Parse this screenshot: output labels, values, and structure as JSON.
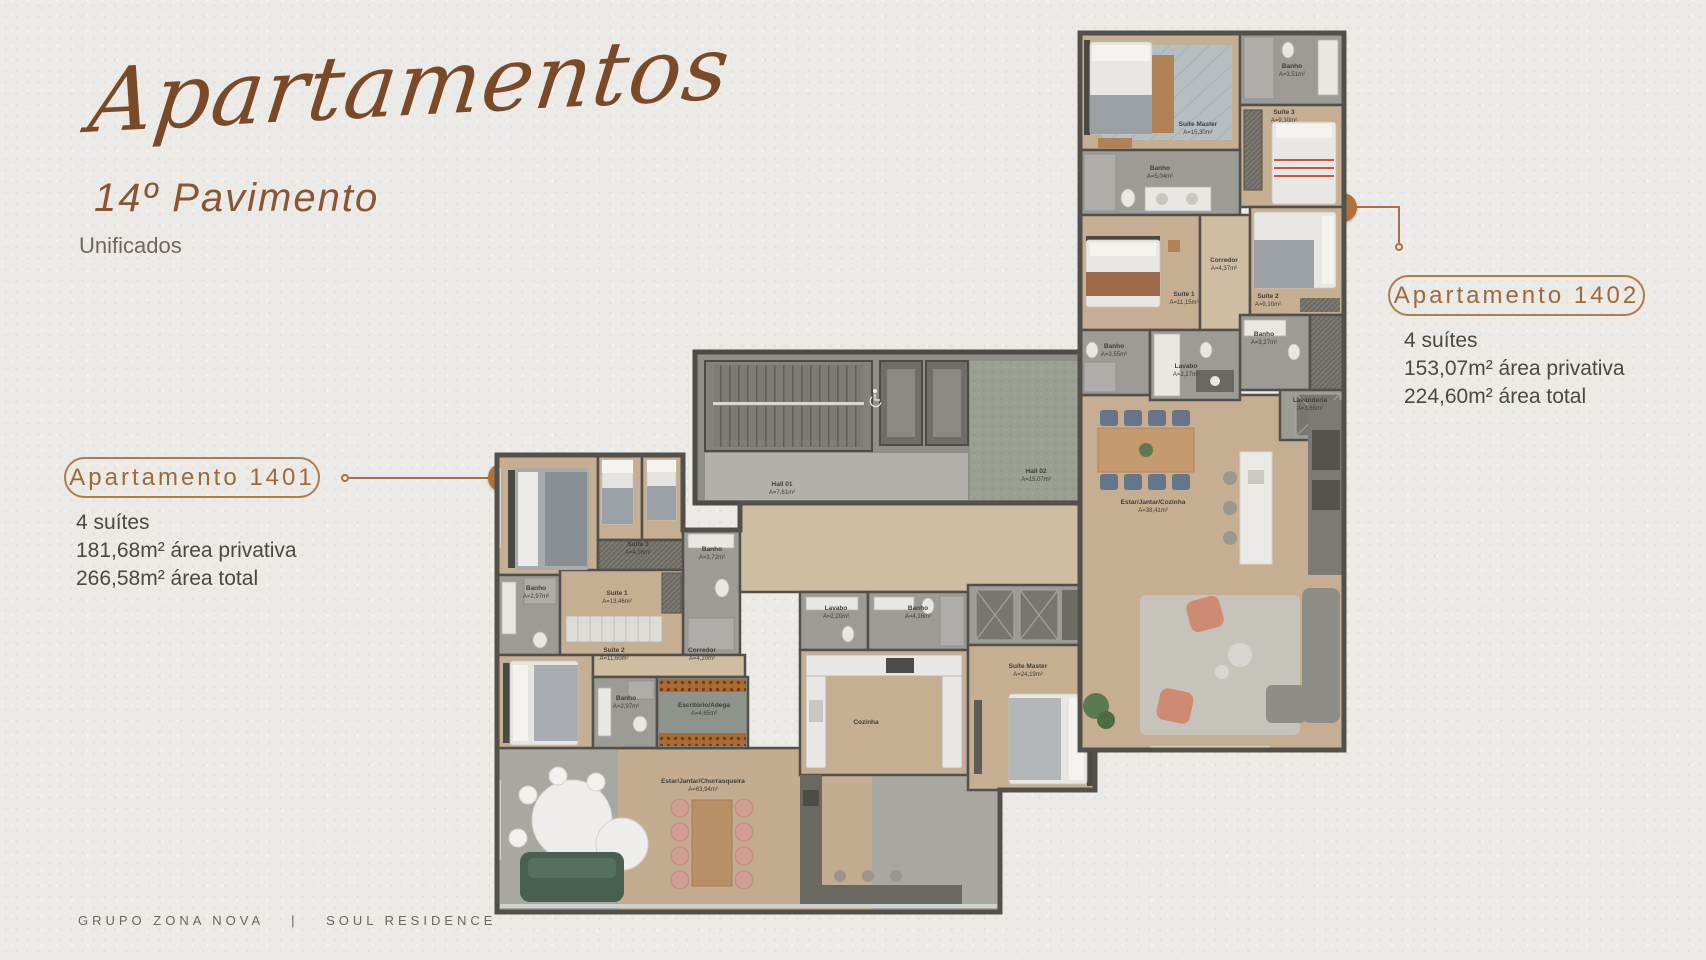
{
  "header": {
    "script_title": "Apartamentos",
    "floor_title": "14º Pavimento",
    "subtitle": "Unificados"
  },
  "footer": {
    "brand": "GRUPO ZONA NOVA",
    "separator": "|",
    "project": "SOUL RESIDENCE"
  },
  "apartments": [
    {
      "marker": "1",
      "card_label": "Apartamento 1401",
      "suites": "4 suítes",
      "private_area": "181,68m² área privativa",
      "total_area": "266,58m² área total"
    },
    {
      "marker": "2",
      "card_label": "Apartamento 1402",
      "suites": "4 suítes",
      "private_area": "153,07m² área privativa",
      "total_area": "224,60m² área total"
    }
  ],
  "floorplan_1401": {
    "rooms": [
      {
        "name": "Suíte 3",
        "area": "A=4,36m²"
      },
      {
        "name": "Banho",
        "area": "A=3,72m²"
      },
      {
        "name": "Banho",
        "area": "A=2,97m²"
      },
      {
        "name": "Suíte 1",
        "area": "A=13,46m²"
      },
      {
        "name": "Suíte 2",
        "area": "A=11,60m²"
      },
      {
        "name": "Corredor",
        "area": "A=4,20m²"
      },
      {
        "name": "Banho",
        "area": "A=2,97m²"
      },
      {
        "name": "Escritório/Adega",
        "area": "A=4,65m²"
      },
      {
        "name": "Lavabo",
        "area": "A=2,20m²"
      },
      {
        "name": "Banho",
        "area": "A=4,16m²"
      },
      {
        "name": "Suíte Master",
        "area": "A=24,19m²"
      },
      {
        "name": "Cozinha",
        "area": ""
      },
      {
        "name": "Estar/Jantar/Churrasqueira",
        "area": "A=63,94m²"
      }
    ]
  },
  "floorplan_core": {
    "rooms": [
      {
        "name": "Hall 01",
        "area": "A=7,61m²"
      },
      {
        "name": "Hall 02",
        "area": "A=15,07m²"
      }
    ]
  },
  "floorplan_1402": {
    "rooms": [
      {
        "name": "Suíte Master",
        "area": "A=15,30m²"
      },
      {
        "name": "Banho",
        "area": "A=3,51m²"
      },
      {
        "name": "Suíte 3",
        "area": "A=9,30m²"
      },
      {
        "name": "Banho",
        "area": "A=5,04m²"
      },
      {
        "name": "Corredor",
        "area": "A=4,37m²"
      },
      {
        "name": "Suíte 1",
        "area": "A=11,15m²"
      },
      {
        "name": "Suíte 2",
        "area": "A=9,10m²"
      },
      {
        "name": "Banho",
        "area": "A=3,55m²"
      },
      {
        "name": "Banho",
        "area": "A=3,27m²"
      },
      {
        "name": "Lavabo",
        "area": "A=2,27m²"
      },
      {
        "name": "Lavanderia",
        "area": "A=3,65m²"
      },
      {
        "name": "Estar/Jantar/Cozinha",
        "area": "A=38,41m²"
      }
    ]
  },
  "colors": {
    "background": "#eceae7",
    "title_brown": "#7a4a28",
    "accent_brown": "#a9713d",
    "marker_orange": "#b27036",
    "wall_gray": "#53504b",
    "text_dark": "#4c4740"
  }
}
